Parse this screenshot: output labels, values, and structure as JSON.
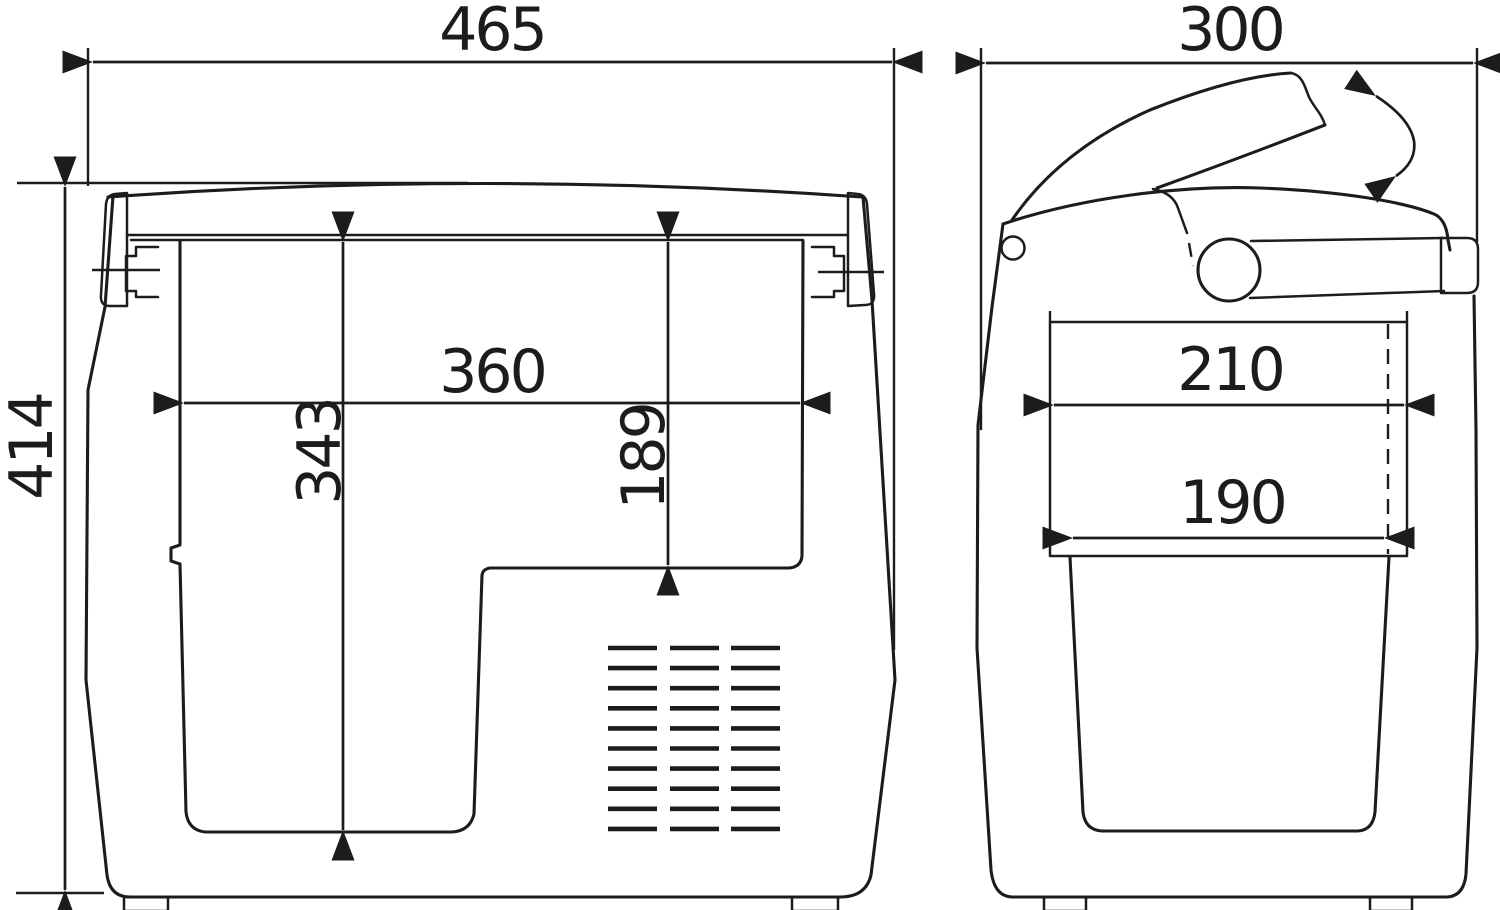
{
  "colors": {
    "line": "#1c1c1c",
    "background": "#ffffff"
  },
  "dimensions": {
    "front": {
      "overall_width": "465",
      "overall_height": "414",
      "inner_width": "360",
      "inner_height_full": "343",
      "inner_height_upper": "189"
    },
    "side": {
      "overall_depth": "300",
      "inner_depth_upper": "210",
      "inner_depth_lower": "190"
    }
  }
}
